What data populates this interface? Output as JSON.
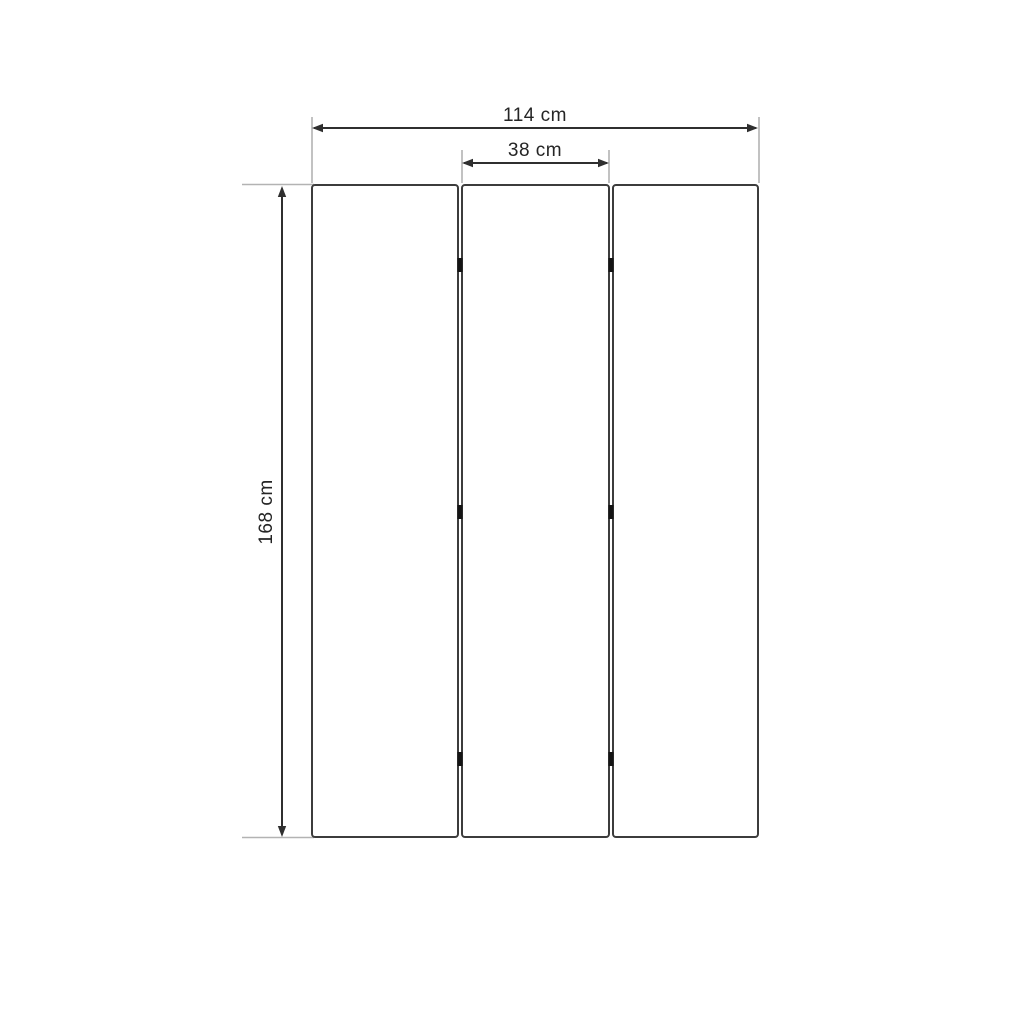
{
  "diagram": {
    "kind": "dimensioned-drawing",
    "panel_count": 3,
    "labels": {
      "total_width": "114 cm",
      "panel_width": "38 cm",
      "height": "168 cm"
    },
    "values": {
      "total_width_cm": 114,
      "panel_width_cm": 38,
      "height_cm": 168
    },
    "colors": {
      "background": "#ffffff",
      "panel_fill": "#ffffff",
      "panel_border": "#3c3c3c",
      "dimension_line": "#2f2f2f",
      "extension_line": "#b3b3b3",
      "text": "#252525",
      "hinge": "#141414"
    }
  }
}
